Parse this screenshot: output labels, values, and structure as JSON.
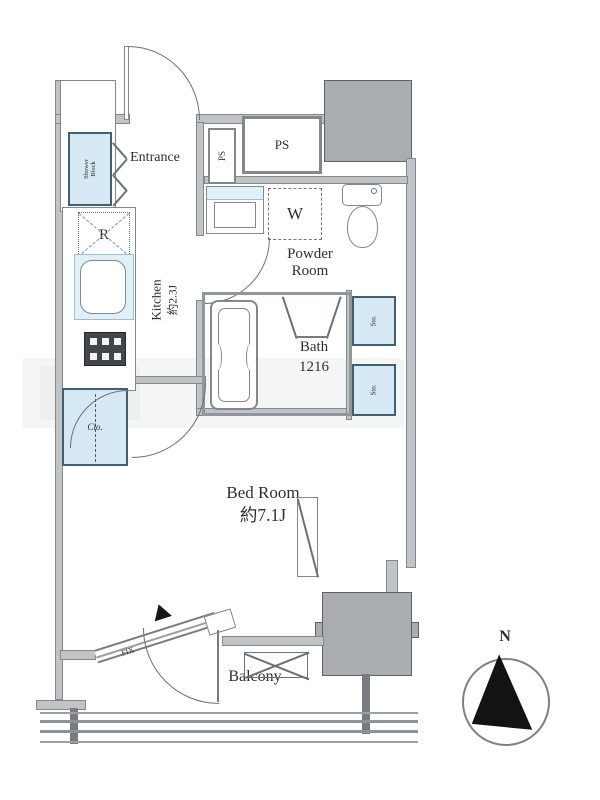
{
  "plan": {
    "rooms": {
      "entrance": "Entrance",
      "kitchen_line1": "Kitchen",
      "kitchen_line2": "約2.3J",
      "powder_line1": "Powder",
      "powder_line2": "Room",
      "bath_line1": "Bath",
      "bath_line2": "1216",
      "bedroom_line1": "Bed Room",
      "bedroom_line2": "約7.1J",
      "balcony": "Balcony"
    },
    "fixtures": {
      "shower_block_line1": "Shower",
      "shower_block_line2": "Block",
      "refrigerator": "R",
      "washer": "W",
      "closet": "Clo.",
      "storage_upper": "Sto.",
      "storage_lower": "Sto.",
      "ps_small": "PS",
      "ps_large": "PS",
      "fix_window": "FIX"
    },
    "compass": {
      "north": "N"
    },
    "colors": {
      "wall_fill": "#c0c4c6",
      "pillar_fill": "#a9adb0",
      "fixture_blue": "#d6e8f3",
      "line": "#6d7175",
      "text": "#2d3033"
    }
  }
}
